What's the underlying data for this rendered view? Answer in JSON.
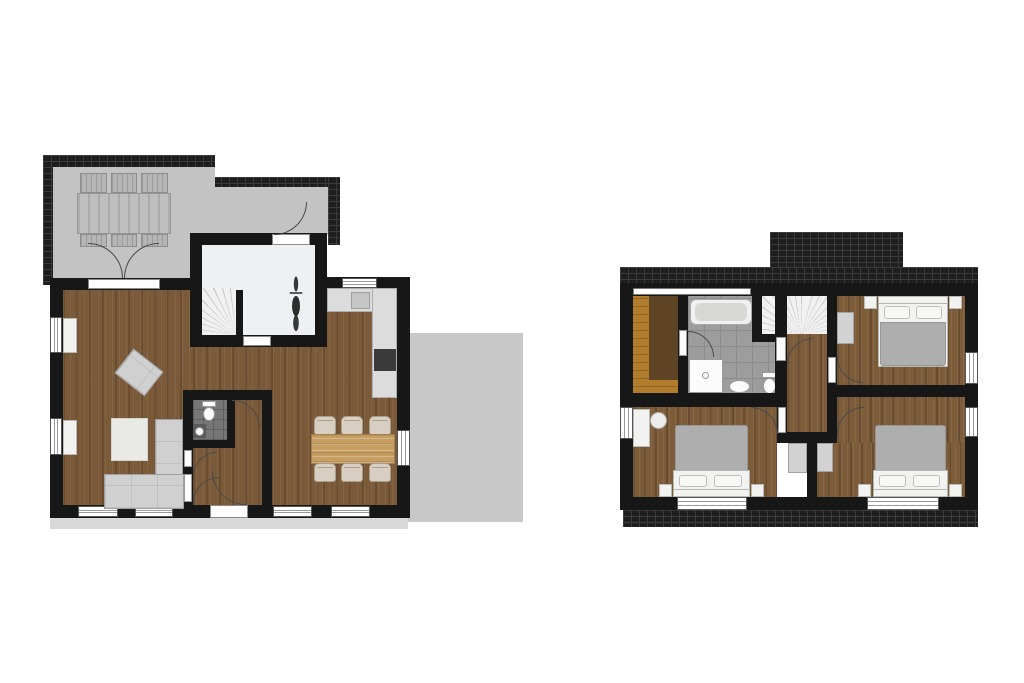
{
  "meta": {
    "type": "residential-floor-plan",
    "floor_count": 2,
    "text_labels": []
  },
  "colors": {
    "bg": "#ffffff",
    "wall": "#171717",
    "roof": "#1e1e1e",
    "roofline": "#3b3b3b",
    "terrace": "#c3c3c3",
    "drive": "#c8c8c8",
    "walk": "#d9d9d9",
    "wood": "#7b5a39",
    "woodUp": "#7d5c3a",
    "whiteroom": "#edf1f3",
    "stair": "#f1f1f1",
    "stairline": "#c7c7c7",
    "tile": "#9d9d9d",
    "tileline": "#8c8c8c",
    "wctile": "#767676",
    "saunabench": "#b17d2d",
    "saunafloor": "#5e4425",
    "furn": "#d2d2d2",
    "furnline": "#a2a2a2",
    "sofa": "#d0d0d0",
    "blanket": "#aeaeae",
    "bedwhite": "#f2f2f0",
    "counter": "#dcdcdc",
    "stove": "#3a3a3a",
    "tablewood": "#c79e62",
    "chair": "#d8cfc2",
    "frame": "#555555",
    "doorline": "#4a4a4a"
  },
  "ground_floor": {
    "rooms": [
      "terrace",
      "covered-porch",
      "living-room",
      "dining-area",
      "kitchen",
      "storage-room",
      "stairs",
      "wc",
      "hallway",
      "driveway"
    ],
    "furniture": {
      "terrace": [
        "outdoor-dining-table",
        "outdoor-chairs-x6"
      ],
      "living_room": [
        "corner-sofa",
        "armchair",
        "rug",
        "sideboard-x2"
      ],
      "dining_area": [
        "dining-table",
        "dining-chairs-x6"
      ],
      "kitchen": [
        "counter-top",
        "sink",
        "stove"
      ],
      "wc": [
        "toilet",
        "washbasin"
      ],
      "storage_room": [
        "motorcycle"
      ]
    },
    "doors": [
      "terrace-double-door",
      "storage-exterior-door",
      "storage-interior-door",
      "wc-door",
      "hall-closet-doors-x2",
      "front-door"
    ]
  },
  "upper_floor": {
    "rooms": [
      "sauna",
      "bathroom",
      "stairwell",
      "hallway",
      "bedroom-1",
      "bedroom-2",
      "bedroom-3"
    ],
    "furniture": {
      "sauna": [
        "wood-bench"
      ],
      "bathroom": [
        "bathtub",
        "shower",
        "washbasin",
        "toilet"
      ],
      "bedroom_1": [
        "double-bed",
        "nightstand-x2",
        "wardrobe"
      ],
      "bedroom_2": [
        "double-bed",
        "nightstand-x2",
        "wardrobe",
        "desk",
        "desk-chair"
      ],
      "bedroom_3": [
        "double-bed",
        "nightstand-x2",
        "wardrobe"
      ]
    },
    "doors": [
      "sauna-bathroom-door",
      "bathroom-hall-door",
      "bedroom-1-door",
      "bedroom-2-door",
      "bedroom-3-door"
    ]
  }
}
